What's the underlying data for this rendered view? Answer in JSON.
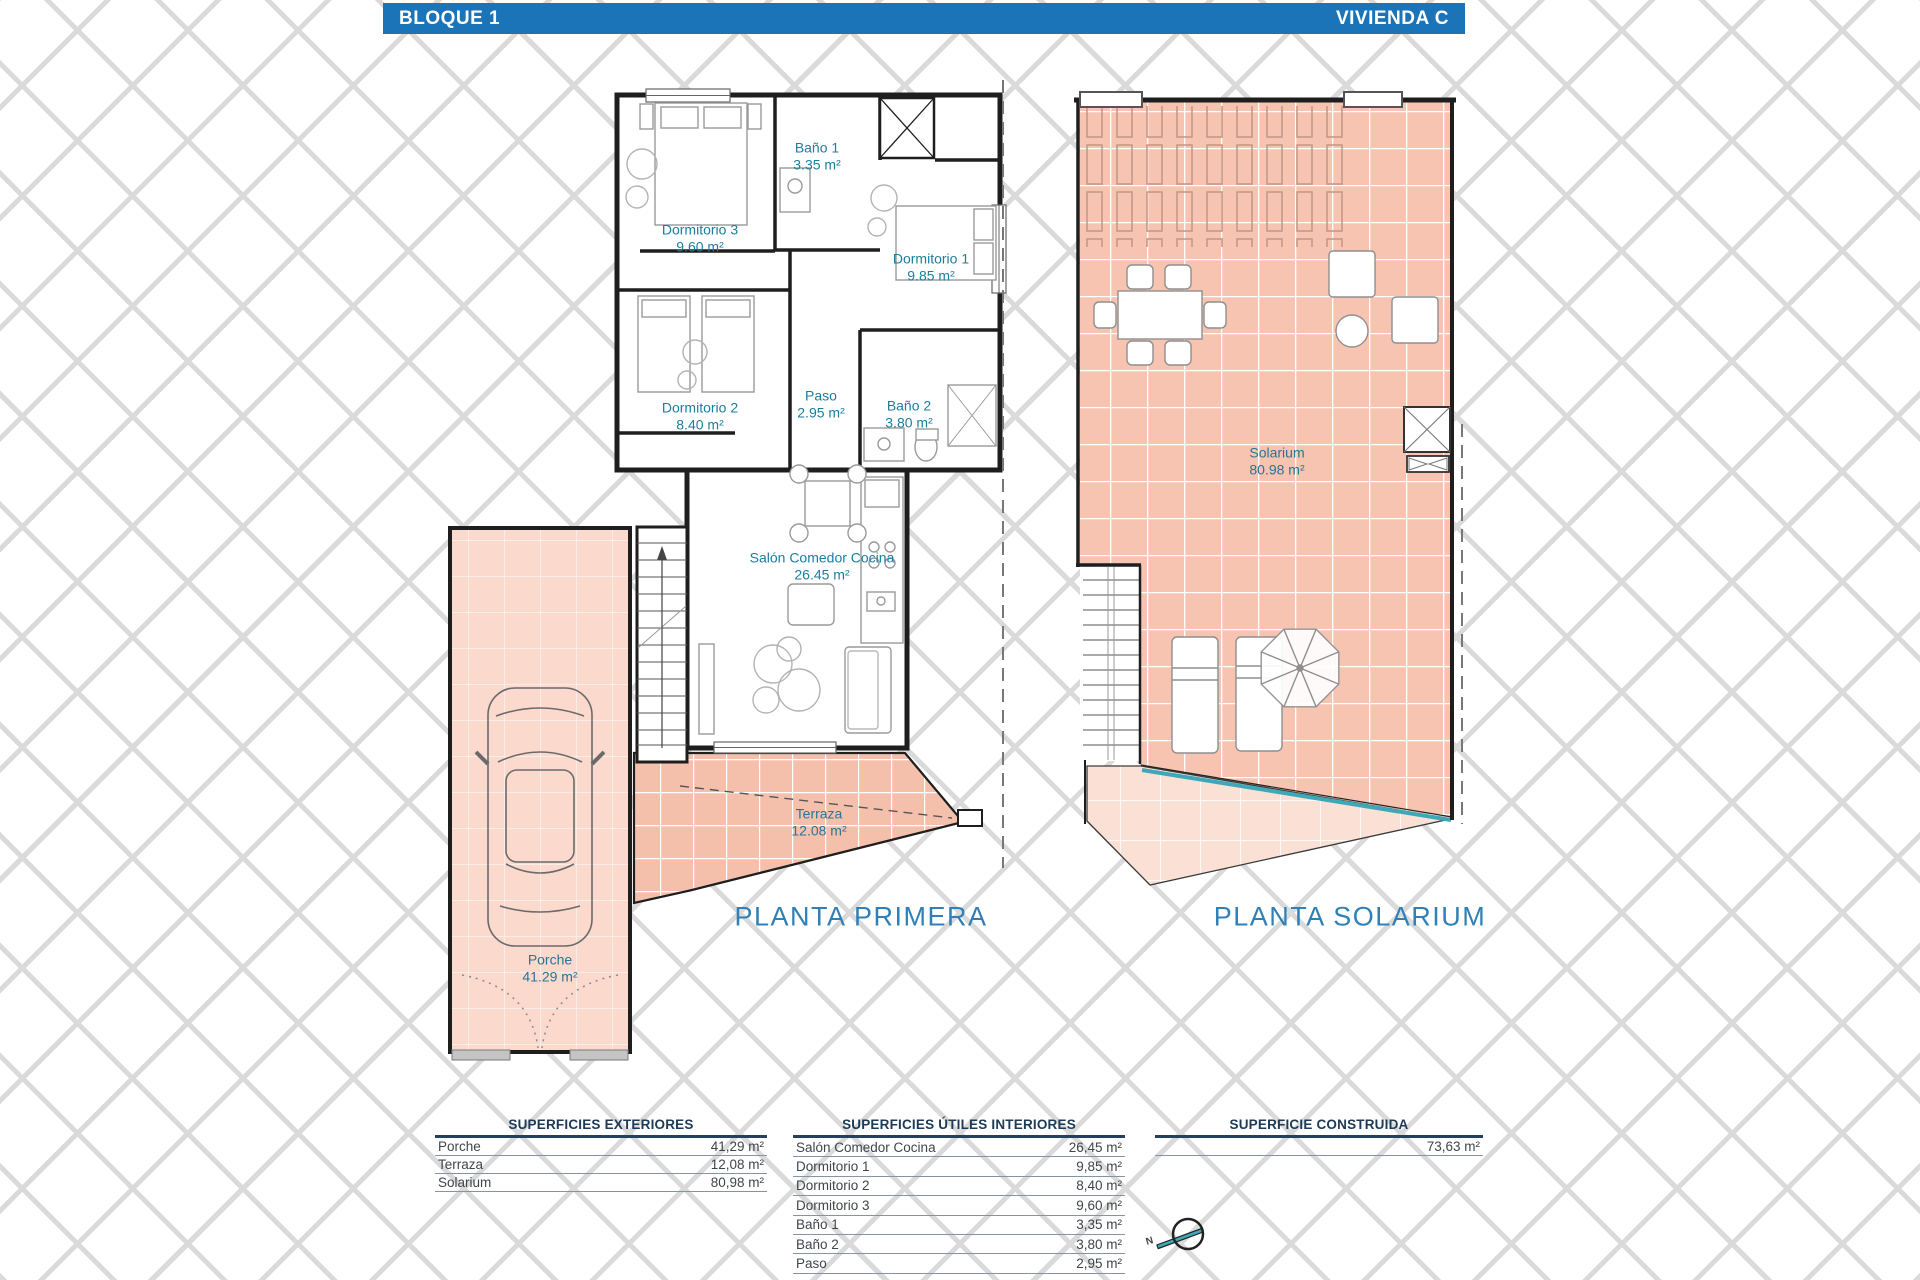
{
  "header": {
    "block": "BLOQUE 1",
    "unit": "VIVIENDA C"
  },
  "plan_primera": {
    "title": "PLANTA PRIMERA",
    "rooms": {
      "dormitorio3": {
        "name": "Dormitorio 3",
        "area": "9.60 m²"
      },
      "bano1": {
        "name": "Baño 1",
        "area": "3.35 m²"
      },
      "dormitorio1": {
        "name": "Dormitorio 1",
        "area": "9.85 m²"
      },
      "dormitorio2": {
        "name": "Dormitorio 2",
        "area": "8.40 m²"
      },
      "paso": {
        "name": "Paso",
        "area": "2.95 m²"
      },
      "bano2": {
        "name": "Baño 2",
        "area": "3.80 m²"
      },
      "salon": {
        "name": "Salón Comedor Cocina",
        "area": "26.45 m²"
      },
      "terraza": {
        "name": "Terraza",
        "area": "12.08 m²"
      },
      "porche": {
        "name": "Porche",
        "area": "41.29 m²"
      }
    }
  },
  "plan_solarium": {
    "title": "PLANTA SOLARIUM",
    "rooms": {
      "solarium": {
        "name": "Solarium",
        "area": "80.98 m²"
      }
    }
  },
  "tables": {
    "exteriores": {
      "title": "SUPERFICIES EXTERIORES",
      "rows": [
        {
          "label": "Porche",
          "value": "41,29 m²"
        },
        {
          "label": "Terraza",
          "value": "12,08 m²"
        },
        {
          "label": "Solarium",
          "value": "80,98 m²"
        }
      ]
    },
    "interiores": {
      "title": "SUPERFICIES ÚTILES INTERIORES",
      "rows": [
        {
          "label": "Salón Comedor Cocina",
          "value": "26,45 m²"
        },
        {
          "label": "Dormitorio 1",
          "value": "9,85 m²"
        },
        {
          "label": "Dormitorio 2",
          "value": "8,40 m²"
        },
        {
          "label": "Dormitorio 3",
          "value": "9,60 m²"
        },
        {
          "label": "Baño 1",
          "value": "3,35 m²"
        },
        {
          "label": "Baño 2",
          "value": "3,80 m²"
        },
        {
          "label": "Paso",
          "value": "2,95 m²"
        }
      ]
    },
    "construida": {
      "title": "SUPERFICIE CONSTRUIDA",
      "rows": [
        {
          "label": "",
          "value": "73,63 m²"
        }
      ]
    }
  },
  "compass": {
    "north_label": "N"
  },
  "colors": {
    "header_bg": "#1c74b8",
    "room_label": "#1b7e9e",
    "exterior_label": "#2d7396",
    "plan_title": "#2f80b6",
    "table_title": "#1d3a57",
    "tile_salmon": "#f6c4b1",
    "tile_porche": "#fbd9cc",
    "tile_light": "#fbe0d6",
    "teal_line": "#3fa8b8",
    "wall": "#1e1e1e"
  }
}
